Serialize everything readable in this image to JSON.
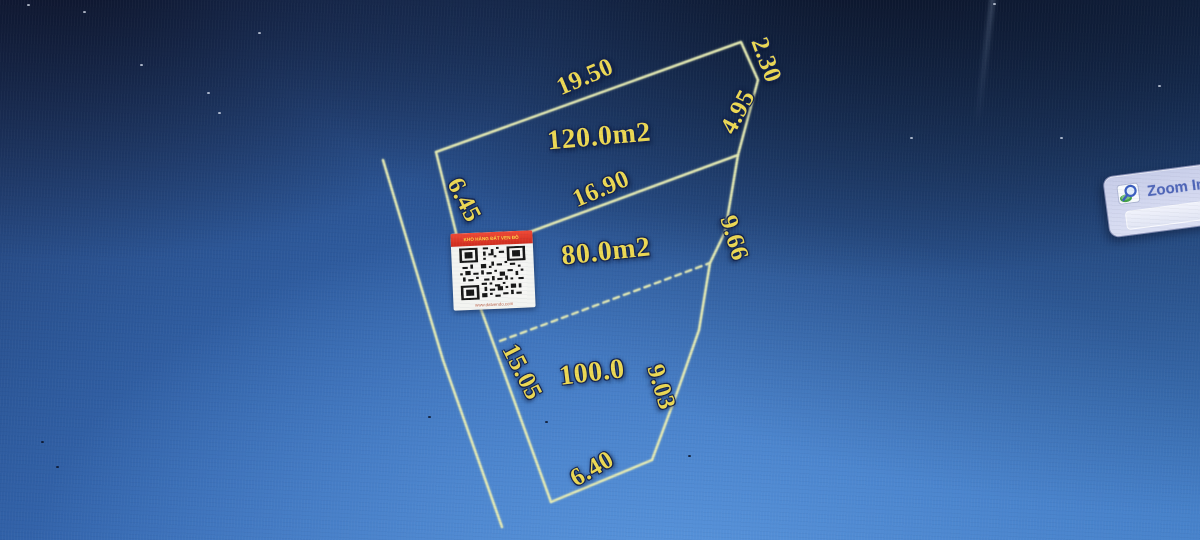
{
  "drawing": {
    "parcel_areas": {
      "top": "120.0m2",
      "middle": "80.0m2",
      "bottom": "100.0"
    },
    "dimensions": {
      "top_edge": "19.50",
      "top_right_short_edge": "2.30",
      "upper_right_edge": "4.95",
      "upper_left_edge": "6.45",
      "middle_edge": "16.90",
      "middle_right_edge": "9.66",
      "lower_left_edge": "15.05",
      "lower_right_edge": "9.03",
      "bottom_edge": "6.40"
    }
  },
  "watermark": {
    "banner_text": "KHO HÀNG ĐẤT VEN ĐÔ",
    "website_text": "www.datvendo.com"
  },
  "toolbar": {
    "zoom_in_label": "Zoom In"
  },
  "colors": {
    "line_yellow": "#e6ebb4",
    "text_yellow": "#ecd853",
    "banner_red": "#d93527",
    "button_text_blue": "#4f66b8",
    "screen_blue": "#2c5ba2"
  }
}
